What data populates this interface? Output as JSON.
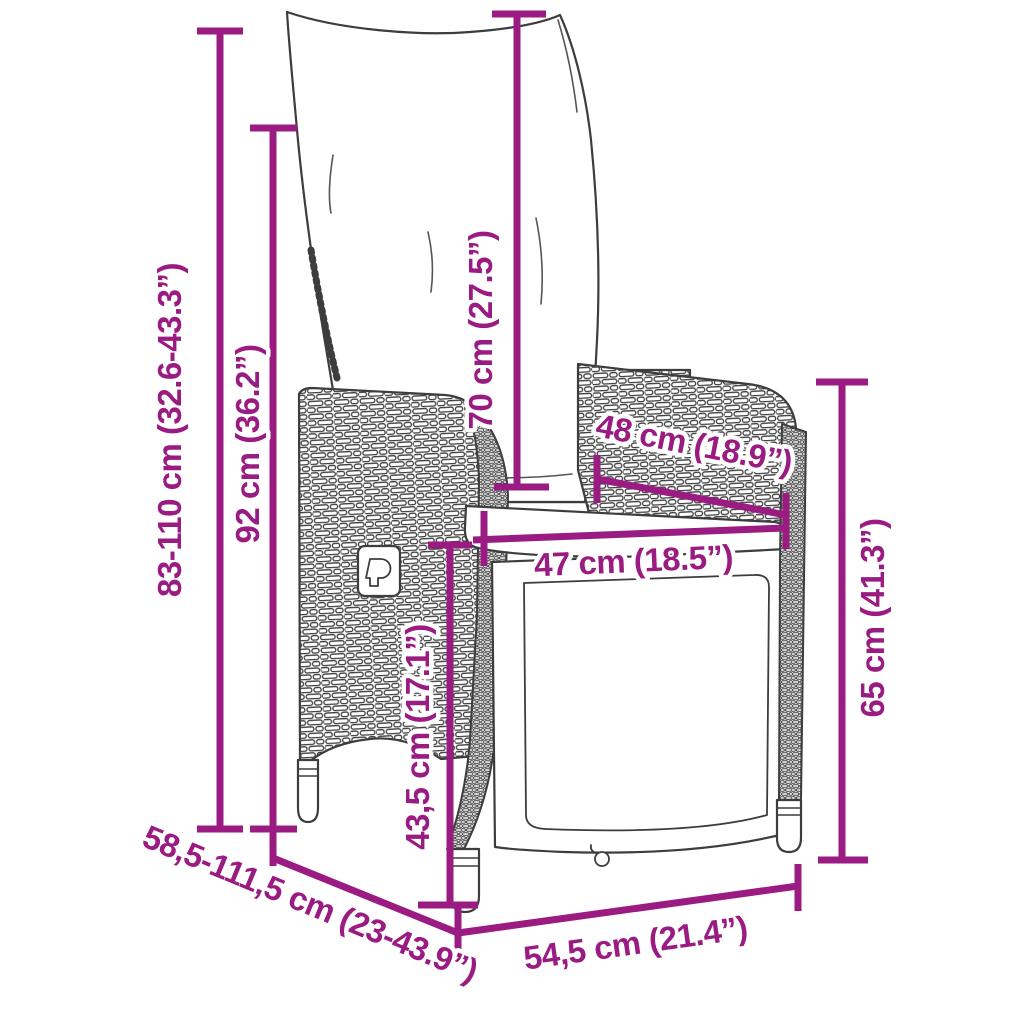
{
  "figure": {
    "accent_color": "#9A1B82",
    "outline_color": "#3D3D3D",
    "background_color": "#FFFFFF"
  },
  "dims": {
    "total_height": "83-110 cm (32.6-43.3”)",
    "backrest_height": "92 cm (36.2”)",
    "back_cushion_length": "70 cm (27.5”)",
    "armrest_length": "48 cm (18.9”)",
    "seat_width": "47 cm (18.5”)",
    "side_height": "65 cm (41.3”)",
    "seat_height": "43,5 cm (17.1”)",
    "depth_range": "58,5-111,5 cm (23-43.9”)",
    "base_width": "54,5 cm (21.4”)"
  }
}
